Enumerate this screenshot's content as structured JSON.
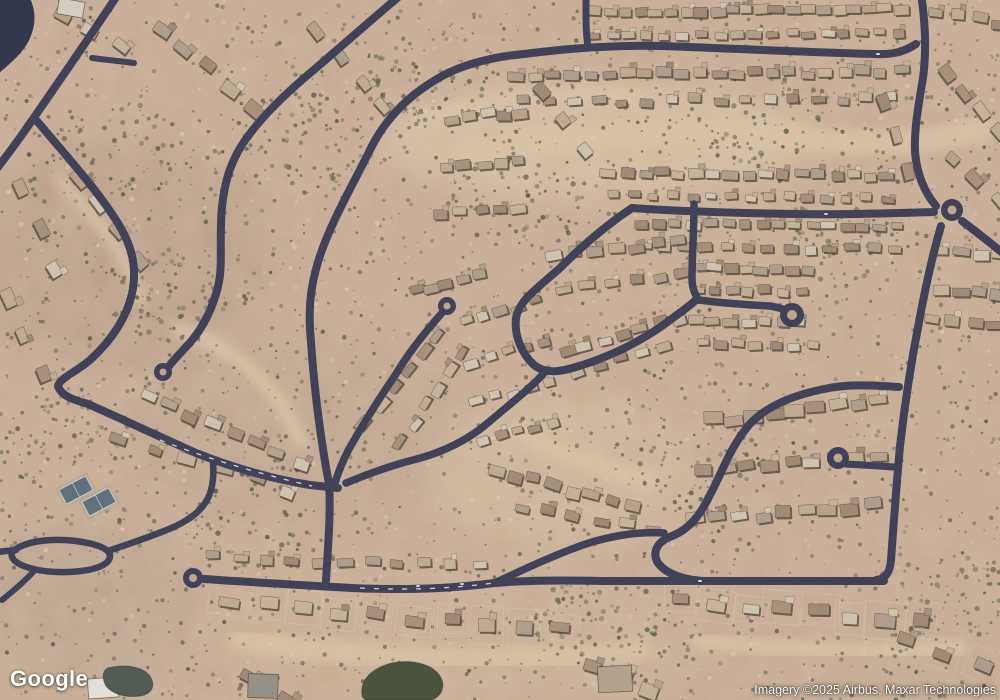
{
  "map": {
    "attribution": {
      "logo_text": "Google",
      "imagery_credit": "Imagery ©2025 Airbus, Maxar Technologies"
    },
    "colors": {
      "desert_base": "#c9ad96",
      "wash": "#ddc7ab",
      "road": "#3a3b55",
      "road_island": "#c2a88f",
      "house_shadow": "#4a4238",
      "lot_line": "#e6d9c2",
      "blob": "#2c3149",
      "pond_left": "#4c5751",
      "pond_right": "#454f3b",
      "court_fill": "#5c6e7c",
      "court_line": "#cdd4cd",
      "car": "#f2f2ee"
    },
    "house_palette": [
      "#b9a48d",
      "#c8b59c",
      "#a7927e",
      "#d3c7b6",
      "#9e8a76",
      "#c2ad94",
      "#b0a090"
    ],
    "shrub_palette": [
      "#5d6050",
      "#6c6e5a",
      "#4c5042",
      "#77775f",
      "#565a48"
    ],
    "green_zones": [
      [
        300,
        140
      ],
      [
        160,
        300
      ],
      [
        520,
        200
      ],
      [
        700,
        470
      ],
      [
        250,
        520
      ],
      [
        850,
        240
      ],
      [
        120,
        150
      ],
      [
        600,
        620
      ],
      [
        420,
        90
      ],
      [
        760,
        120
      ],
      [
        60,
        440
      ],
      [
        940,
        600
      ]
    ],
    "terrain": {
      "tints": [
        {
          "cx": 120,
          "cy": 250,
          "rx": 160,
          "ry": 120,
          "c": "#b49b86",
          "o": 0.5
        },
        {
          "cx": 300,
          "cy": 430,
          "rx": 180,
          "ry": 100,
          "c": "#baa28c",
          "o": 0.45
        },
        {
          "cx": 600,
          "cy": 140,
          "rx": 220,
          "ry": 60,
          "c": "#dfc9ad",
          "o": 0.6
        },
        {
          "cx": 560,
          "cy": 470,
          "rx": 140,
          "ry": 80,
          "c": "#d8c2a6",
          "o": 0.5
        },
        {
          "cx": 860,
          "cy": 350,
          "rx": 120,
          "ry": 160,
          "c": "#c7ad94",
          "o": 0.4
        },
        {
          "cx": 460,
          "cy": 640,
          "rx": 260,
          "ry": 70,
          "c": "#cdb49a",
          "o": 0.5
        },
        {
          "cx": 80,
          "cy": 600,
          "rx": 120,
          "ry": 80,
          "c": "#b7a18d",
          "o": 0.5
        },
        {
          "cx": 940,
          "cy": 640,
          "rx": 90,
          "ry": 70,
          "c": "#c3a98f",
          "o": 0.4
        },
        {
          "cx": 240,
          "cy": 90,
          "rx": 150,
          "ry": 80,
          "c": "#c9ae95",
          "o": 0.4
        },
        {
          "cx": 750,
          "cy": 250,
          "rx": 150,
          "ry": 60,
          "c": "#cdb297",
          "o": 0.4
        }
      ],
      "washes": [
        {
          "d": "M460,160 C560,130 700,128 820,140 C880,146 930,142 980,130",
          "w": 26
        },
        {
          "d": "M420,120 C480,100 560,92 640,96",
          "w": 14
        },
        {
          "d": "M180,330 C240,350 280,390 300,440",
          "w": 16
        },
        {
          "d": "M520,430 C560,452 600,470 650,480",
          "w": 18
        },
        {
          "d": "M240,640 C360,660 520,664 640,650",
          "w": 22
        },
        {
          "d": "M700,640 C780,650 860,655 960,648",
          "w": 16
        },
        {
          "d": "M60,180 C100,220 130,260 140,300",
          "w": 12
        }
      ],
      "blob": "M0,-2 L30,-2 C36,12 36,24 30,38 C24,52 12,62 -2,74 Z",
      "water": [
        {
          "d": "M108,668 C124,664 142,666 150,676 C156,686 152,694 140,696 C126,698 112,694 106,686 C102,678 102,671 108,668 Z",
          "fill": "#4c5751"
        },
        {
          "d": "M362,694 C360,680 372,668 392,663 C412,659 432,664 440,676 C446,686 442,696 432,700 L366,700 C362,698 362,696 362,694 Z",
          "fill": "#454f3b"
        }
      ]
    },
    "roads": [
      {
        "d": "M118,-6 C100,22 64,74 42,106 C28,126 12,150 -6,172",
        "w": 8
      },
      {
        "d": "M92,58 C106,60 120,61 134,63",
        "w": 6
      },
      {
        "d": "M36,120 C58,146 92,184 112,214 C130,240 137,262 133,288 C129,316 110,342 90,360 C76,372 60,378 58,386 C61,396 74,400 88,404 C124,420 158,436 196,453 C234,468 272,479 310,485 L338,488",
        "w": 8
      },
      {
        "d": "M402,-6 C378,14 344,44 316,68 C292,88 268,110 252,131 C230,158 222,186 221,224 C220,256 223,272 216,294 C208,320 197,336 185,348 C177,357 170,364 166,370",
        "w": 8
      },
      {
        "d": "M524,54 C490,57 458,66 437,79 C408,96 384,120 369,152 C350,190 329,226 318,262 C310,288 308,312 311,342 C314,388 321,442 329,484 C331,512 328,546 326,581",
        "w": 8
      },
      {
        "d": "M441,314 C427,330 409,352 396,374 C381,396 363,424 349,449 C341,464 337,476 334,486",
        "w": 7.5
      },
      {
        "d": "M544,373 C530,389 511,403 489,422 C467,441 441,453 413,460 C389,466 363,476 346,483",
        "w": 7.5
      },
      {
        "d": "M632,208 C608,224 582,246 560,268 C538,288 519,300 516,318 C514,336 522,354 534,365 C545,374 560,372 576,367 C606,358 636,344 662,326 C678,314 690,306 697,299",
        "w": 8
      },
      {
        "d": "M694,204 C694,230 692,258 692,278 C692,288 695,295 699,300",
        "w": 7.5
      },
      {
        "d": "M699,300 C722,303 750,305 770,306 C782,308 790,311 794,316",
        "w": 7.5
      },
      {
        "d": "M899,387 C872,385 846,384 824,389 C794,395 766,406 749,425 C731,446 723,470 711,493 C701,514 690,529 672,536 C656,542 652,553 658,563 C666,574 684,580 704,581 L884,581",
        "w": 8
      },
      {
        "d": "M495,583 C522,570 548,558 572,549 C602,537 636,531 664,533",
        "w": 7.5
      },
      {
        "d": "M204,579 C262,583 318,586 352,588 C420,591 462,587 495,583 C530,580 562,580 600,581 L712,581",
        "w": 8
      },
      {
        "d": "M921,-6 C925,20 927,48 923,78 C918,108 914,130 915,152 C917,176 926,194 936,206",
        "w": 8
      },
      {
        "d": "M941,226 C934,250 926,284 919,322 C912,358 905,402 900,446 C896,490 893,532 891,560 C890,572 886,579 876,580",
        "w": 8
      },
      {
        "d": "M962,221 C974,230 988,241 1004,254",
        "w": 8
      },
      {
        "d": "M632,208 C676,211 736,213 796,214 C846,215 900,213 934,212",
        "w": 8
      },
      {
        "d": "M524,54 C570,48 618,45 662,46 C722,48 800,52 874,54 C892,55 904,52 916,44",
        "w": 8
      },
      {
        "d": "M586,-6 L586,18 C586,32 587,40 588,48",
        "w": 7
      },
      {
        "d": "M846,464 C862,465 880,466 894,467",
        "w": 7
      },
      {
        "d": "M16,549 C28,541 52,538 76,541 C98,544 110,549 110,556 C110,565 94,571 68,572 C44,573 22,568 14,560 C10,555 11,552 16,549 Z",
        "w": 6.5
      },
      {
        "d": "M108,551 C132,543 158,534 176,526 C192,518 202,510 208,498 C213,488 214,474 213,464",
        "w": 6.5
      },
      {
        "d": "M16,550 C6,551 -4,552 -10,553",
        "w": 6.5
      },
      {
        "d": "M34,571 C24,582 12,592 2,600",
        "w": 6
      }
    ],
    "bulbs": [
      {
        "cx": 163,
        "cy": 372,
        "r": 9,
        "ir": 3.5
      },
      {
        "cx": 447,
        "cy": 306,
        "r": 9,
        "ir": 3.5
      },
      {
        "cx": 193,
        "cy": 578,
        "r": 10,
        "ir": 4
      },
      {
        "cx": 792,
        "cy": 315,
        "r": 12,
        "ir": 5
      },
      {
        "cx": 838,
        "cy": 458,
        "r": 11,
        "ir": 4.5
      },
      {
        "cx": 952,
        "cy": 210,
        "r": 11,
        "ir": 4.5
      }
    ],
    "road_dashes": [
      {
        "d": "M160,440 C200,456 252,472 312,486",
        "w": 1.3,
        "dash": "5,8"
      },
      {
        "d": "M360,588 C420,591 462,587 494,583",
        "w": 1.3,
        "dash": "5,9"
      }
    ],
    "cars": [
      {
        "x": 418,
        "y": 586,
        "r": -2
      },
      {
        "x": 462,
        "y": 584,
        "r": -2
      },
      {
        "x": 826,
        "y": 214,
        "r": 2
      },
      {
        "x": 878,
        "y": 54,
        "r": 0
      },
      {
        "x": 700,
        "y": 581,
        "r": 0
      }
    ],
    "tennis_courts": [
      {
        "cx": 76,
        "cy": 490,
        "w": 30,
        "h": 16,
        "rot": -28
      },
      {
        "cx": 99,
        "cy": 502,
        "w": 30,
        "h": 16,
        "rot": -28
      }
    ],
    "buildings": [
      {
        "x": 88,
        "y": 678,
        "w": 30,
        "h": 20,
        "rot": -4,
        "fill": "#e9e6dd"
      },
      {
        "x": 248,
        "y": 674,
        "w": 30,
        "h": 24,
        "rot": 2,
        "fill": "#97918a"
      },
      {
        "x": 598,
        "y": 666,
        "w": 34,
        "h": 26,
        "rot": -3,
        "fill": "#b5a48e"
      },
      {
        "x": 58,
        "y": 0,
        "w": 26,
        "h": 16,
        "rot": 10,
        "fill": "#d8d2c6"
      }
    ],
    "house_rows": [
      [
        594,
        12,
        900,
        9,
        21,
        10,
        2,
        0
      ],
      [
        594,
        36,
        898,
        33,
        18,
        9,
        2,
        0
      ],
      [
        938,
        14,
        998,
        22,
        4,
        11,
        3,
        0
      ],
      [
        516,
        76,
        900,
        72,
        22,
        10,
        3,
        0
      ],
      [
        524,
        102,
        892,
        98,
        16,
        9,
        3,
        0
      ],
      [
        948,
        75,
        996,
        130,
        4,
        12,
        4,
        0
      ],
      [
        884,
        100,
        908,
        170,
        3,
        11,
        4,
        0
      ],
      [
        954,
        155,
        998,
        200,
        3,
        11,
        4,
        0
      ],
      [
        610,
        172,
        888,
        176,
        17,
        10,
        2,
        0
      ],
      [
        614,
        195,
        886,
        198,
        15,
        8,
        2,
        0
      ],
      [
        642,
        223,
        898,
        227,
        16,
        9,
        2,
        0
      ],
      [
        644,
        246,
        894,
        249,
        13,
        9,
        3,
        0
      ],
      [
        700,
        268,
        806,
        271,
        8,
        10,
        2,
        0
      ],
      [
        697,
        289,
        800,
        292,
        7,
        9,
        2,
        0
      ],
      [
        694,
        320,
        800,
        323,
        7,
        10,
        2,
        0
      ],
      [
        702,
        343,
        812,
        346,
        7,
        9,
        2,
        0
      ],
      [
        942,
        252,
        1000,
        257,
        4,
        11,
        3,
        0
      ],
      [
        940,
        288,
        998,
        292,
        4,
        11,
        3,
        0
      ],
      [
        934,
        322,
        994,
        327,
        4,
        11,
        3,
        0
      ],
      [
        158,
        32,
        258,
        106,
        5,
        13,
        6,
        0
      ],
      [
        64,
        12,
        118,
        48,
        3,
        12,
        5,
        0
      ],
      [
        320,
        30,
        382,
        108,
        4,
        12,
        5,
        0
      ],
      [
        452,
        118,
        520,
        112,
        5,
        10,
        3,
        0
      ],
      [
        446,
        168,
        520,
        162,
        5,
        10,
        3,
        0
      ],
      [
        442,
        214,
        520,
        208,
        5,
        10,
        3,
        0
      ],
      [
        540,
        92,
        588,
        148,
        3,
        11,
        4,
        0
      ],
      [
        76,
        178,
        140,
        258,
        4,
        12,
        5,
        0
      ],
      [
        18,
        192,
        58,
        268,
        3,
        12,
        5,
        0
      ],
      [
        8,
        300,
        42,
        374,
        3,
        12,
        5,
        0
      ],
      [
        148,
        398,
        300,
        462,
        8,
        11,
        4,
        0
      ],
      [
        120,
        436,
        290,
        492,
        6,
        11,
        4,
        0
      ],
      [
        366,
        424,
        436,
        334,
        6,
        10,
        3,
        0
      ],
      [
        402,
        442,
        462,
        352,
        6,
        10,
        3,
        0
      ],
      [
        416,
        292,
        478,
        276,
        5,
        10,
        3,
        0
      ],
      [
        468,
        322,
        534,
        302,
        5,
        9,
        3,
        0
      ],
      [
        472,
        362,
        542,
        342,
        5,
        9,
        3,
        0
      ],
      [
        478,
        402,
        548,
        382,
        5,
        9,
        3,
        0
      ],
      [
        484,
        440,
        552,
        422,
        5,
        9,
        3,
        0
      ],
      [
        556,
        256,
        678,
        242,
        7,
        10,
        3,
        0
      ],
      [
        562,
        290,
        684,
        272,
        6,
        10,
        3,
        0
      ],
      [
        566,
        350,
        678,
        318,
        7,
        10,
        3,
        0
      ],
      [
        578,
        372,
        662,
        348,
        5,
        9,
        3,
        0
      ],
      [
        496,
        470,
        630,
        506,
        8,
        11,
        3,
        0
      ],
      [
        522,
        506,
        652,
        530,
        6,
        10,
        3,
        0
      ],
      [
        712,
        420,
        878,
        402,
        9,
        12,
        4,
        0
      ],
      [
        704,
        470,
        878,
        454,
        9,
        12,
        4,
        0
      ],
      [
        694,
        520,
        872,
        506,
        9,
        12,
        4,
        0
      ],
      [
        214,
        557,
        478,
        566,
        11,
        10,
        3,
        0
      ],
      [
        232,
        602,
        560,
        632,
        10,
        13,
        5,
        1
      ],
      [
        682,
        600,
        918,
        622,
        8,
        13,
        5,
        1
      ],
      [
        250,
        678,
        286,
        698,
        2,
        14,
        4,
        0
      ],
      [
        592,
        668,
        648,
        690,
        3,
        14,
        5,
        0
      ],
      [
        904,
        640,
        980,
        668,
        3,
        13,
        6,
        1
      ]
    ]
  }
}
